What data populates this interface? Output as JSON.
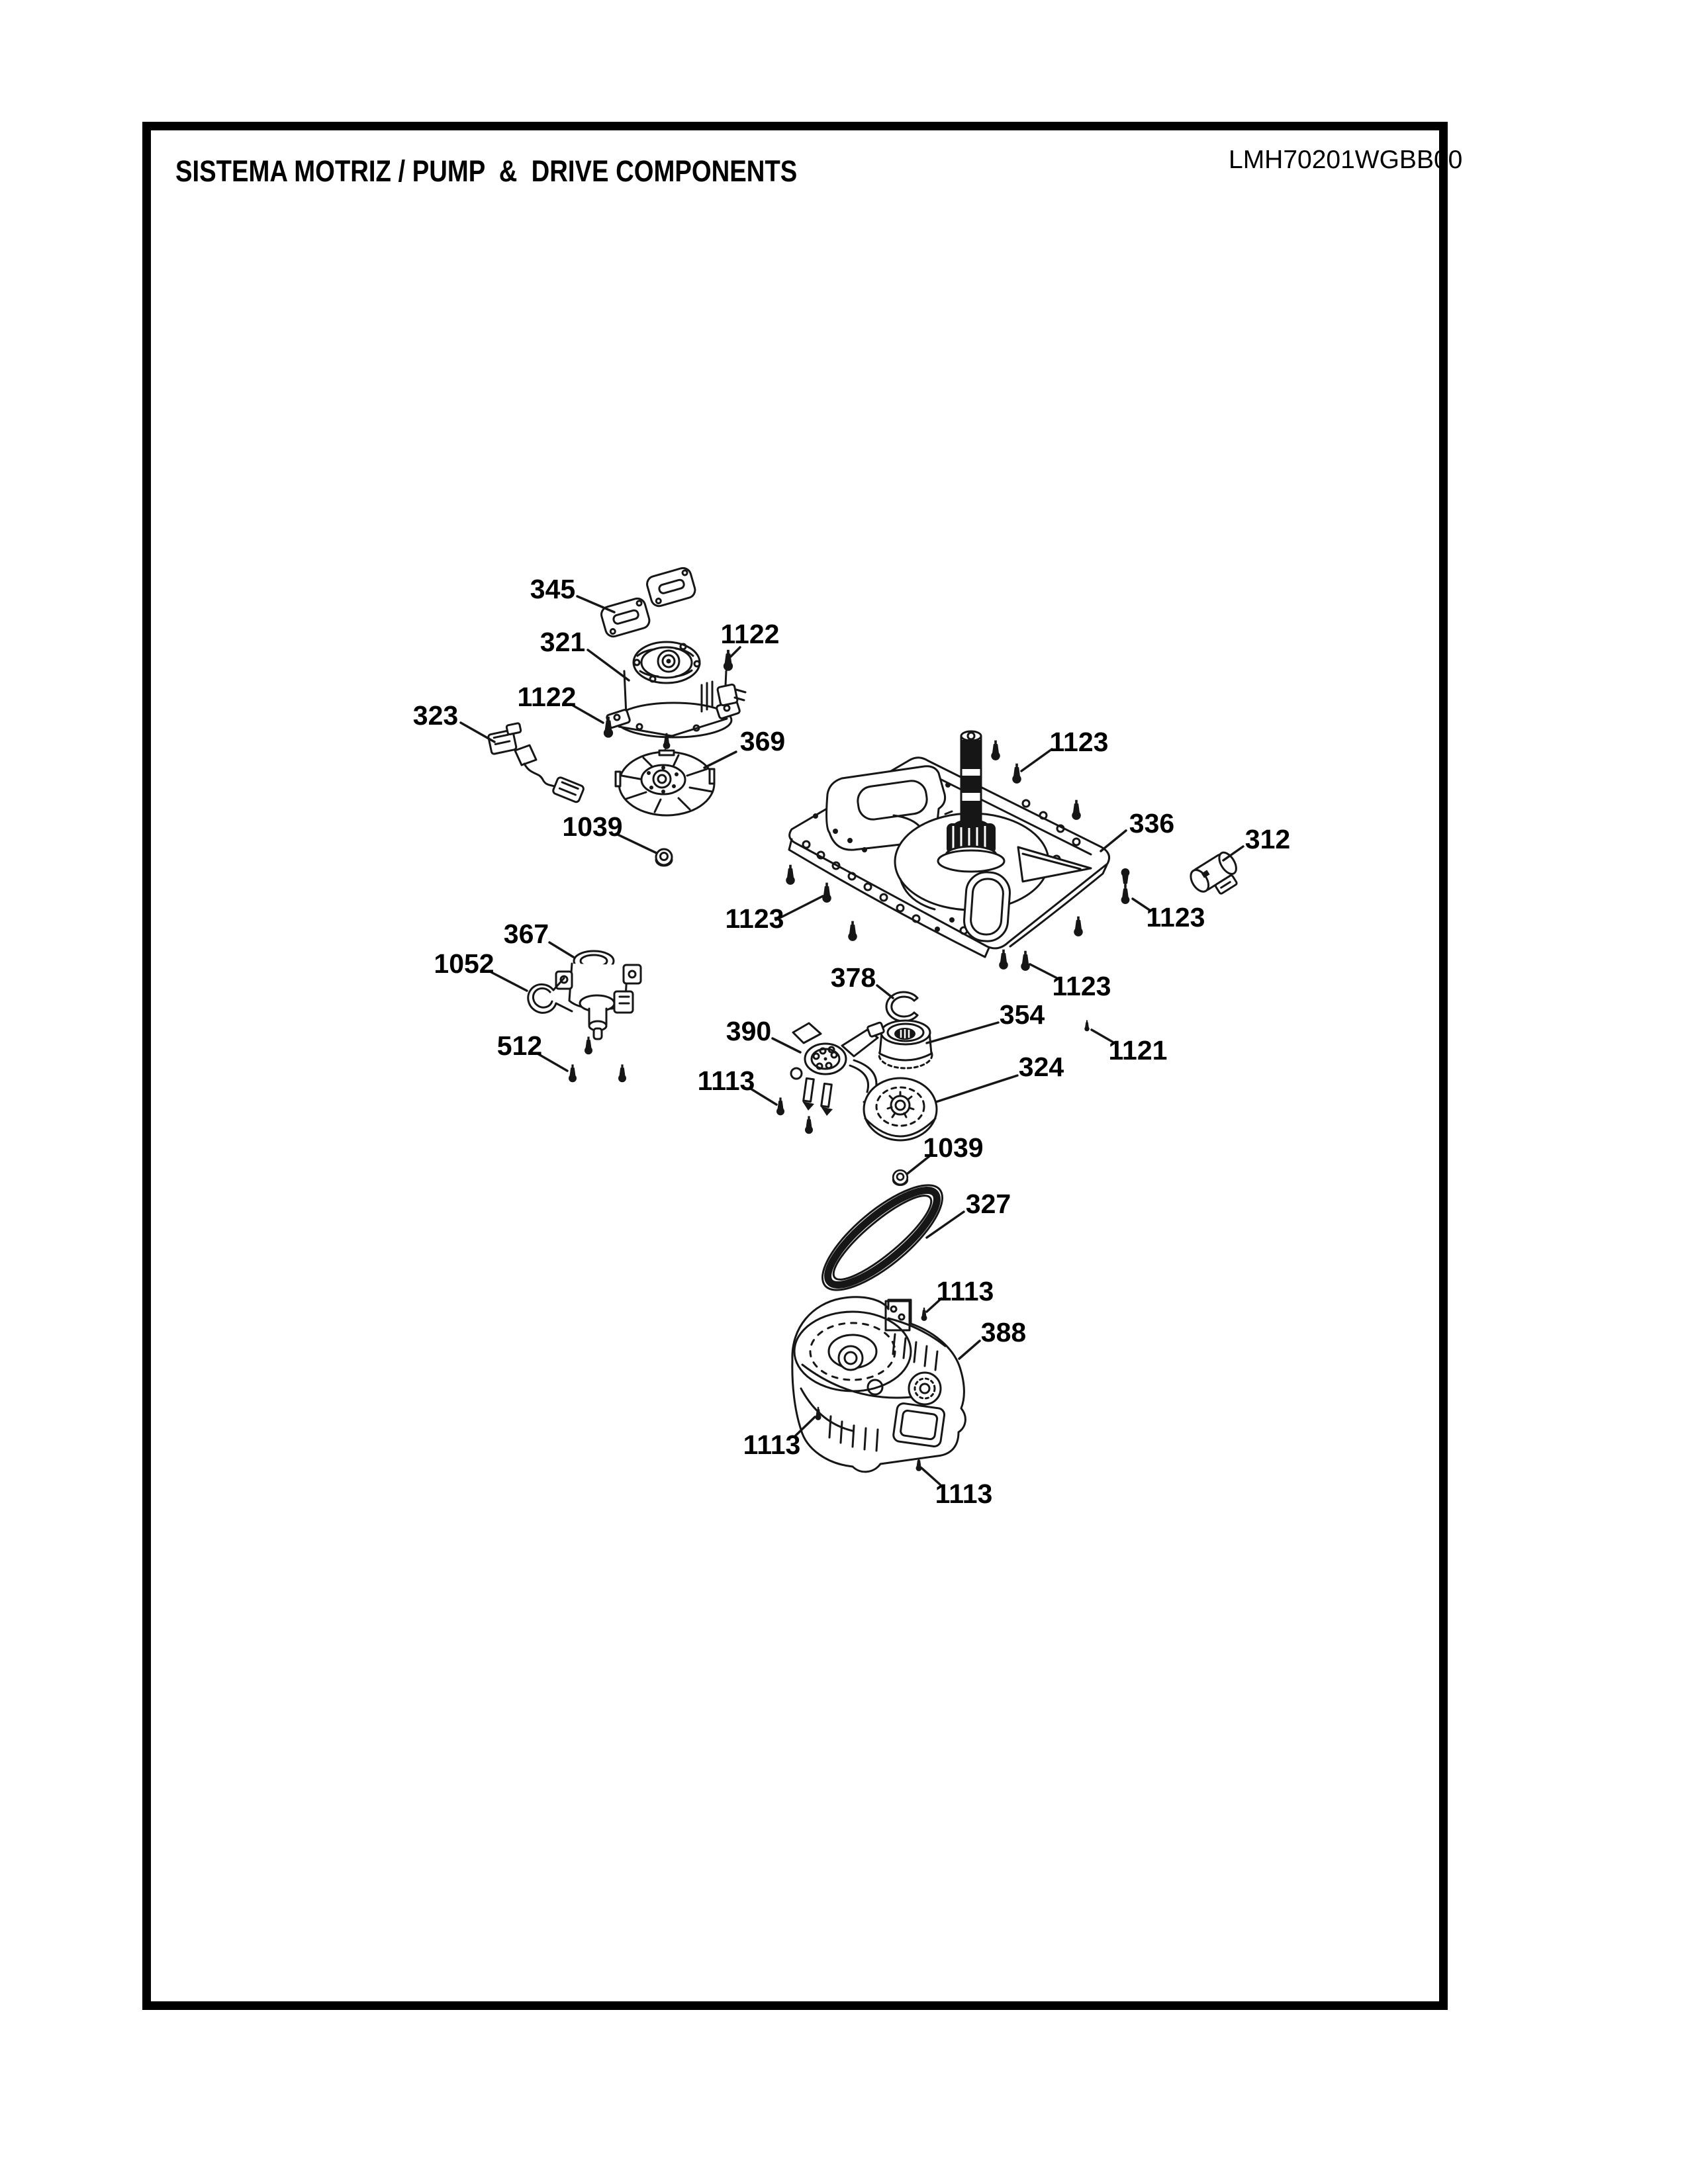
{
  "page": {
    "title": "SISTEMA MOTRIZ / PUMP  &  DRIVE COMPONENTS",
    "model_number": "LMH70201WGBB00"
  },
  "colors": {
    "ink": "#161616",
    "paper": "#ffffff"
  },
  "diagram": {
    "description_visible_text_only": true,
    "callouts": [
      "345",
      "321",
      "1122",
      "1122",
      "323",
      "369",
      "1039",
      "367",
      "1052",
      "512",
      "1123",
      "336",
      "312",
      "1123",
      "1123",
      "1123",
      "378",
      "354",
      "1121",
      "390",
      "324",
      "1113",
      "1039",
      "327",
      "1113",
      "388",
      "1113",
      "1113"
    ]
  }
}
